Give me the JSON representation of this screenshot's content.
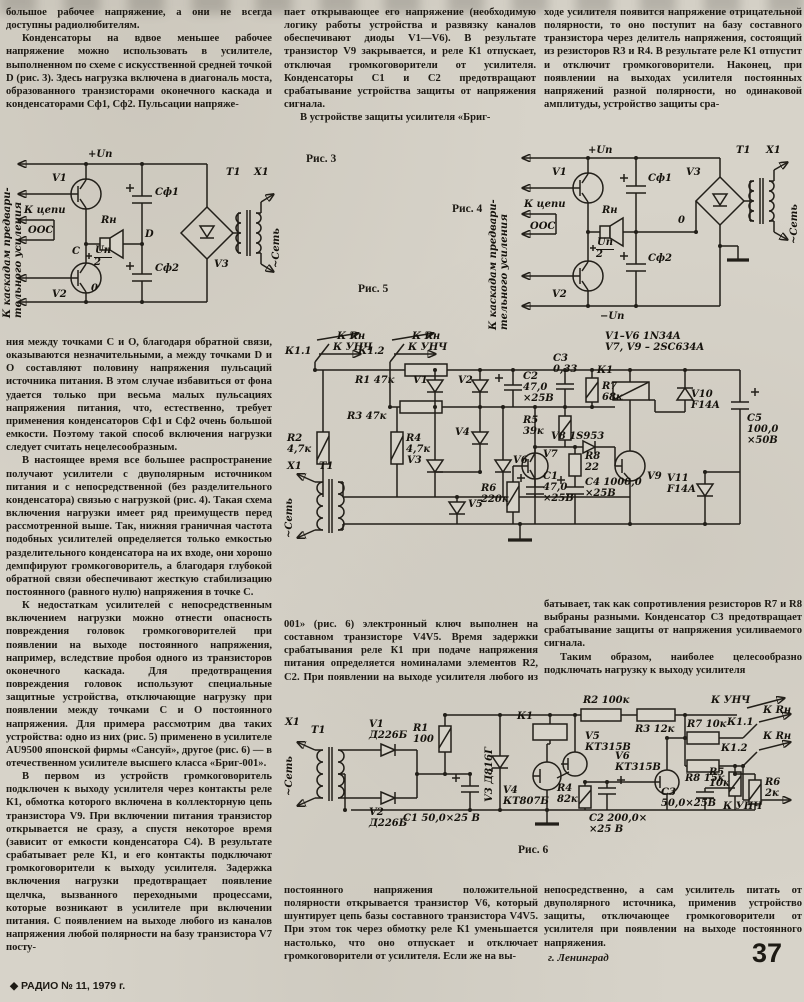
{
  "page": {
    "number": "37",
    "footer": "◆ РАДИО № 11, 1979 г.",
    "signature": "г. Ленинград"
  },
  "text": {
    "c1p1": "большое рабочее напряжение, а они не всегда доступны радиолюбителям.",
    "c1p2": "Конденсаторы на вдвое меньшее рабочее напряжение можно использовать в усилителе, выполненном по схеме с искусственной средней точкой D (рис. 3). Здесь нагрузка включена в диагональ моста, образованного транзисторами оконечного каскада и конденсаторами Сф1, Сф2. Пульсации напряже-",
    "c2p1": "пает открывающее его напряжение (необходимую логику работы устройства и развязку каналов обеспечивают диоды V1—V6). В результате транзистор V9 закрывается, и реле К1 отпускает, отключая громкоговорители от усилителя. Конденсаторы С1 и С2 предотвращают срабатывание устройства защиты от напряжения сигнала.",
    "c2p2": "В устройстве защиты усилителя «Бриг-",
    "c3p1": "ходе усилителя появится напряжение отрицательной полярности, то оно поступит на базу составного транзистора через делитель напряжения, состоящий из резисторов R3 и R4. В результате реле К1 отпустит и отключит громкоговорители. Наконец, при появлении на выходах усилителя постоянных напряжений разной полярности, но одинаковой амплитуды, устройство защиты сра-",
    "c1p3": "ния между точками С и О, благодаря обратной связи, оказываются незначительными, а между точками D и О составляют половину напряжения пульсаций источника питания. В этом случае избавиться от фона удается только при весьма малых пульсациях напряжения питания, что, естественно, требует применения конденсаторов Сф1 и Сф2 очень большой емкости. Поэтому такой способ включения нагрузки следует считать нецелесообразным.",
    "c1p4": "В настоящее время все большее распространение получают усилители с двуполярным источником питания и с непосредственной (без разделительного конденсатора) связью с нагрузкой (рис. 4). Такая схема включения нагрузки имеет ряд преимуществ перед рассмотренной выше. Так, нижняя граничная частота подобных усилителей определяется только емкостью разделительного конденсатора на их входе, они хорошо демпфируют громкоговоритель, а благодаря глубокой обратной связи обеспечивают жесткую стабилизацию постоянного (равного нулю) напряжения в точке С.",
    "c1p5": "К недостаткам усилителей с непосредственным включением нагрузки можно отнести опасность повреждения головок громкоговорителей при появлении на выходе постоянного напряжения, например, вследствие пробоя одного из транзисторов оконечного каскада. Для предотвращения повреждения головок используют специальные защитные устройства, отключающие нагрузку при появлении между точками С и О постоянного напряжения. Для примера рассмотрим два таких устройства: одно из них (рис. 5) применено в усилителе AU9500 японской фирмы «Сансуй», другое (рис. 6) — в отечественном усилителе высшего класса «Бриг-001».",
    "c1p6": "В первом из устройств громкоговоритель подключен к выходу усилителя через контакты реле К1, обмотка которого включена в коллекторную цепь транзистора V9. При включении питания транзистор открывается не сразу, а спустя некоторое время (зависит от емкости конденсатора С4). В результате срабатывает реле К1, и его контакты подключают громкоговорители к выходу усилителя. Задержка включения нагрузки предотвращает появление щелчка, вызванного переходными процессами, которые возникают в усилителе при включении питания. С появлением на выходе любого из каналов напряжения любой полярности на базу транзистора V7 посту-",
    "c2p3": "001» (рис. 6) электронный ключ выполнен на составном транзисторе V4V5. Время задержки срабатывания реле К1 при подаче напряжения питания определяется номиналами элементов R2, С2. При появлении на выходе усилителя любого из каналов",
    "c3p2": "батывает, так как сопротивления резисторов R7 и R8 выбраны разными. Конденсатор С3 предотвращает срабатывание защиты от напряжения усиливаемого сигнала.",
    "c3p3": "Таким образом, наиболее целесообразно подключать нагрузку к выходу усилителя",
    "c2p4": "постоянного напряжения положительной полярности открывается транзистор V6, который шунтирует цепь базы составного транзистора V4V5. При этом ток через обмотку реле К1 уменьшается настолько, что оно отпускает и отключает громкоговорители от усилителя. Если же на вы-",
    "c3p4": "непосредственно, а сам усилитель питать от двуполярного источника, применив устройство защиты, отключающее громкоговорители от усилителя при появлении на выходе постоянного напряжения."
  },
  "fig3": {
    "caption": "Рис. 3",
    "side": [
      "К каскадам предвари-",
      "тельного усиления"
    ],
    "up": "+Uп",
    "v1": "V1",
    "v2": "V2",
    "rn": "Rн",
    "kcepi": "К цепи",
    "oos": "ООС",
    "c": "С",
    "d": "D",
    "o": "0",
    "frac": [
      "Uп",
      "2"
    ],
    "cf1": "Сф1",
    "cf2": "Сф2",
    "v3": "V3",
    "t1": "T1",
    "x1": "X1",
    "net": "~Сеть"
  },
  "fig4": {
    "caption": "Рис. 4",
    "side": [
      "К каскадам предвари-",
      "тельного усиления"
    ],
    "up": "+Uп",
    "un": "−Uп",
    "v1": "V1",
    "v2": "V2",
    "rn": "Rн",
    "kcepi": "К цепи",
    "oos": "ООС",
    "o": "0",
    "frac": [
      "Uп",
      "2"
    ],
    "cf1": "Сф1",
    "cf2": "Сф2",
    "v3": "V3",
    "t1": "T1",
    "x1": "X1",
    "net": "~Сеть"
  },
  "fig5": {
    "caption": "Рис. 5",
    "parts": [
      "V1–V6  1N34A",
      "V7, V9 – 2SC634A"
    ],
    "k11": "К1.1",
    "k12": "К1.2",
    "krn": "К Rн",
    "kunch": "К УНЧ",
    "r1": "R1 47к",
    "r3": "R3 47к",
    "r2": [
      "R2",
      "4,7к"
    ],
    "r4": [
      "R4",
      "4,7к"
    ],
    "v1": "V1",
    "v2": "V2",
    "v3": "V3",
    "v4": "V4",
    "v5": "V5",
    "v6": "V6",
    "c1": [
      "С1",
      "47,0",
      "×25В"
    ],
    "c2": [
      "С2",
      "47,0",
      "×25В"
    ],
    "c3": [
      "С3",
      "0,33"
    ],
    "r5": [
      "R5",
      "39к"
    ],
    "r6": [
      "R6",
      "220к"
    ],
    "r7": [
      "R7",
      "68к"
    ],
    "v8": "V8 1S953",
    "v7": "V7",
    "v9": "V9",
    "k1": "К1",
    "r8": [
      "R8",
      "22"
    ],
    "c4": [
      "С4 1000,0",
      "×25В"
    ],
    "v10": [
      "V10",
      "F14A"
    ],
    "v11": [
      "V11",
      "F14A"
    ],
    "c5": [
      "С5",
      "100,0",
      "×50В"
    ],
    "x1": "X1",
    "t1": "T1",
    "net": "~Сеть"
  },
  "fig6": {
    "caption": "Рис. 6",
    "x1": "X1",
    "t1": "T1",
    "net": "~Сеть",
    "v1": [
      "V1",
      "Д226Б"
    ],
    "v2": [
      "V2",
      "Д226Б"
    ],
    "r1": [
      "R1",
      "100"
    ],
    "c1": "С1 50,0×25 В",
    "v3": "V3 Д816Г",
    "k1": "К1",
    "r2": "R2 100к",
    "r3": "R3 12к",
    "v5": [
      "V5",
      "КТ315В"
    ],
    "v4": [
      "V4",
      "КТ807Б"
    ],
    "r4": [
      "R4",
      "82к"
    ],
    "c2": [
      "С2 200,0×",
      "×25 В"
    ],
    "v6": [
      "V6",
      "КТ315В"
    ],
    "c3": [
      "С3",
      "50,0×25В"
    ],
    "r5": [
      "R5",
      "10к"
    ],
    "r6": [
      "R6",
      "2к"
    ],
    "r7": "R7 10к",
    "r8": "R8 15к",
    "k11": "К1.1",
    "k12": "К1.2",
    "krn": "К Rн",
    "kunch": "К УНЧ"
  }
}
